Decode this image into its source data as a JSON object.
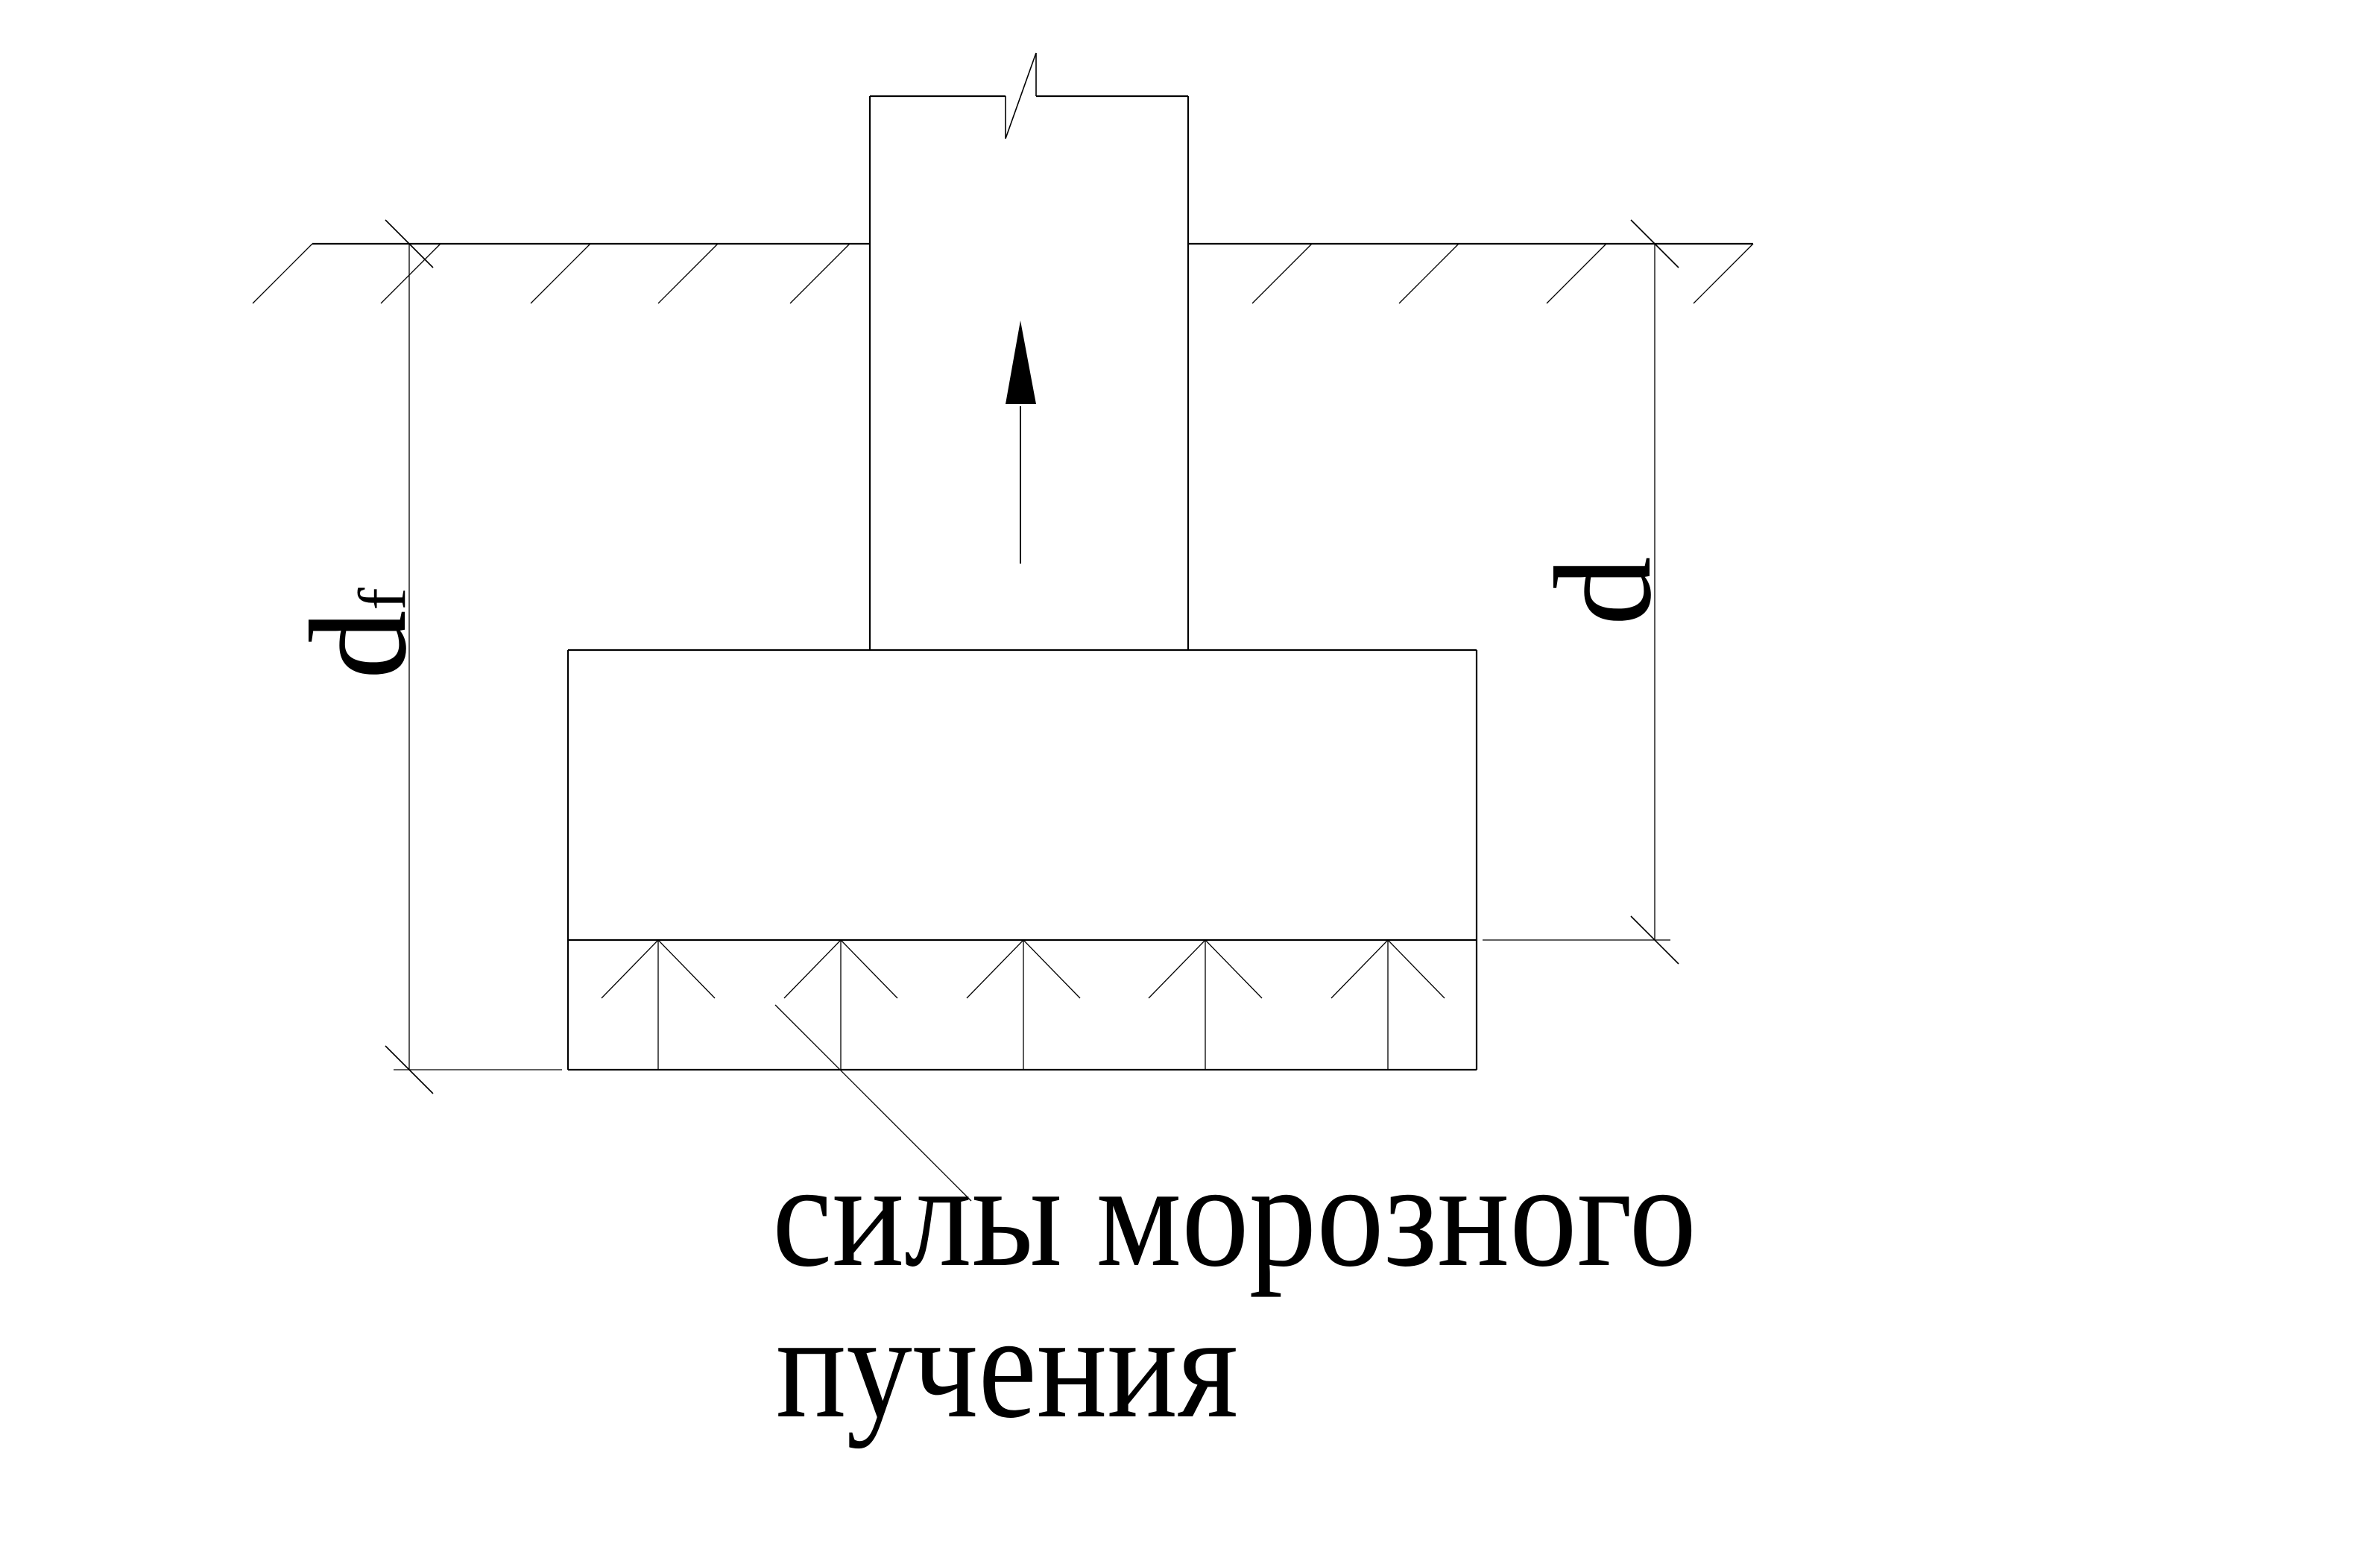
{
  "caption": {
    "line1": "силы морозного",
    "line2": "пучения"
  },
  "labels": {
    "frost_depth_main": "d",
    "frost_depth_sub": "f",
    "foundation_depth": "d"
  },
  "colors": {
    "line": "#000000",
    "text": "#000000",
    "background": "#ffffff"
  }
}
